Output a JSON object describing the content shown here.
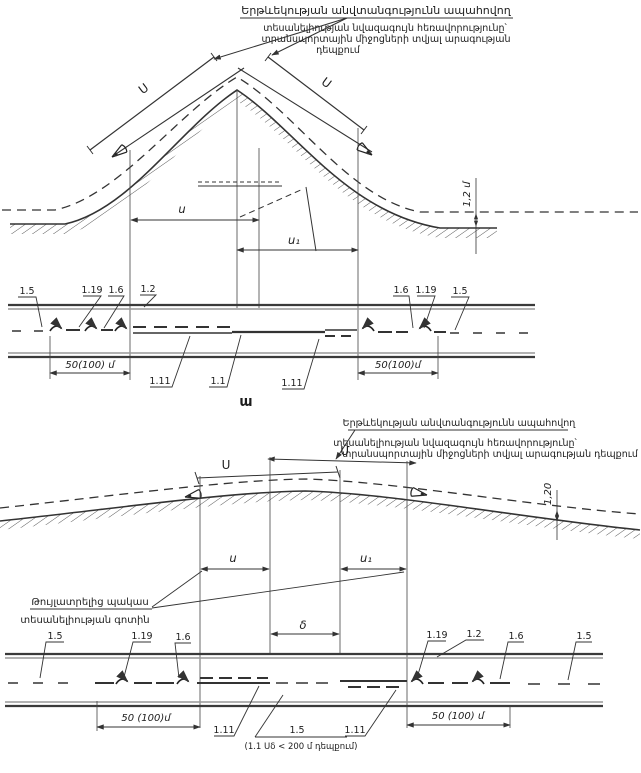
{
  "diagram_top": {
    "caption": {
      "line1": "Երթևեկության անվտանգությունն ապահովող",
      "line2": "տեսանելիության նվազագույն հեռավորությունը՝",
      "line3": "տրանսպորտային միջոցների տվյալ արագության",
      "line4": "դեպքում"
    },
    "labels": {
      "sight_left": "Ս",
      "sight_right": "Ս",
      "zone": "ս",
      "zone1": "ս₁",
      "eye_height": "1,2 մ"
    },
    "plan": {
      "dim_left": "50(100) մ",
      "dim_right": "50(100)մ",
      "marking_15": "1.5",
      "marking_119": "1.19",
      "marking_16": "1.6",
      "marking_12": "1.2",
      "marking_111": "1.11",
      "marking_11": "1.1"
    },
    "figure_label": "ա"
  },
  "diagram_bottom": {
    "caption": {
      "line1": "Երթևեկության անվտանգությունն ապահովող",
      "line2": "տեսանելիության նվազագույն հեռավորությունը՝",
      "line3": "տրանսպորտային միջոցների տվյալ արագության դեպքում"
    },
    "labels": {
      "sight_left": "Ս",
      "sight_right": "Մ",
      "zone": "ս",
      "zone1": "ս₁",
      "gap": "δ",
      "eye_height": "1,20",
      "restricted_zone_line1": "Թույլատրելից պակաս",
      "restricted_zone_line2": "տեսանելիության գոտին"
    },
    "plan": {
      "dim_left": "50 (100)մ",
      "dim_right": "50 (100) մ",
      "note": "(1.1 Սδ < 200 մ դեպքում)",
      "marking_15": "1.5",
      "marking_119": "1.19",
      "marking_16": "1.6",
      "marking_12": "1.2",
      "marking_111": "1.11"
    }
  },
  "colors": {
    "ink": "#1c1c1c",
    "line": "#333333",
    "edge_gray": "#999999"
  }
}
